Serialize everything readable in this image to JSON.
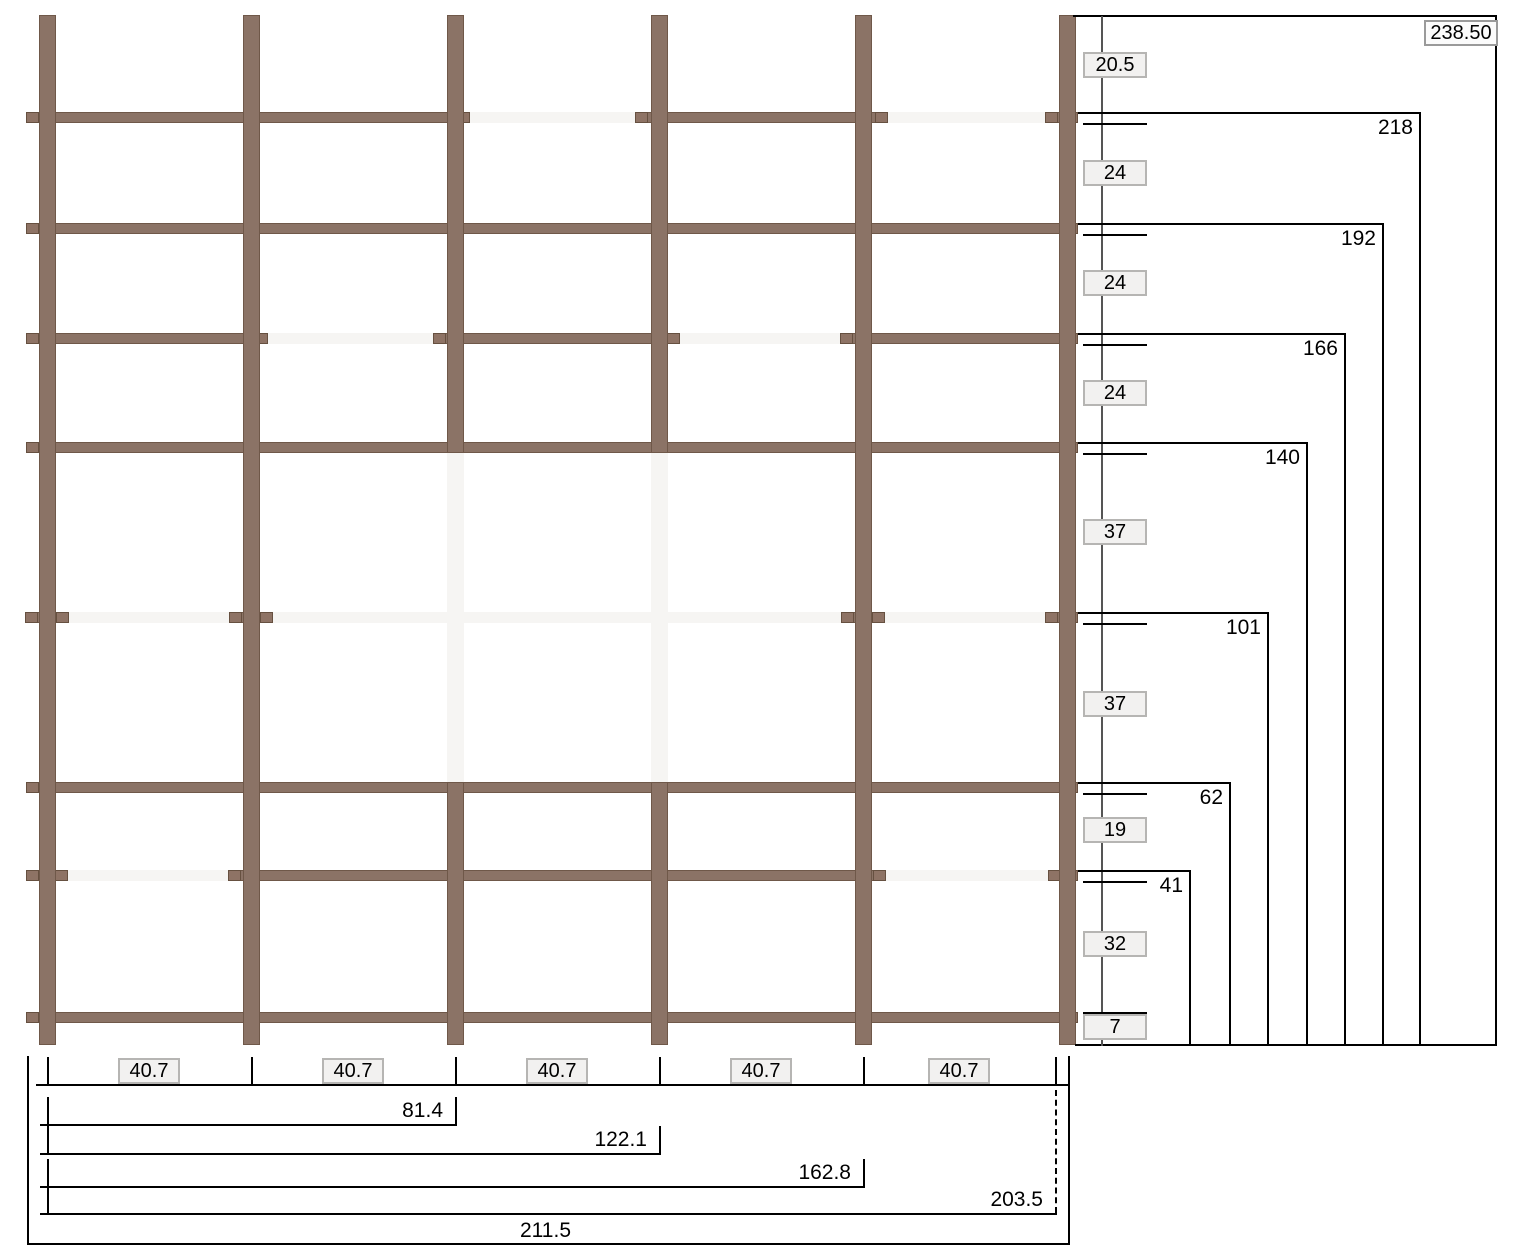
{
  "right_dimensions": {
    "overall": "238.50",
    "levels": [
      "218",
      "192",
      "166",
      "140",
      "101",
      "62",
      "41"
    ],
    "intervals": [
      "20.5",
      "24",
      "24",
      "24",
      "37",
      "37",
      "19",
      "32",
      "7"
    ]
  },
  "bottom_dimensions": {
    "segments": [
      "40.7",
      "40.7",
      "40.7",
      "40.7",
      "40.7"
    ],
    "cumulative": [
      "81.4",
      "122.1",
      "162.8",
      "203.5"
    ],
    "overall": "211.5"
  },
  "colors": {
    "beam": "#8B7366",
    "beam_border": "#6F5849",
    "ghost_member": "#f6f5f3",
    "dimension_line": "#000000",
    "chain_line": "#555555",
    "value_box_bg": "#f2f1f0",
    "value_box_border": "#b6b5b3"
  }
}
